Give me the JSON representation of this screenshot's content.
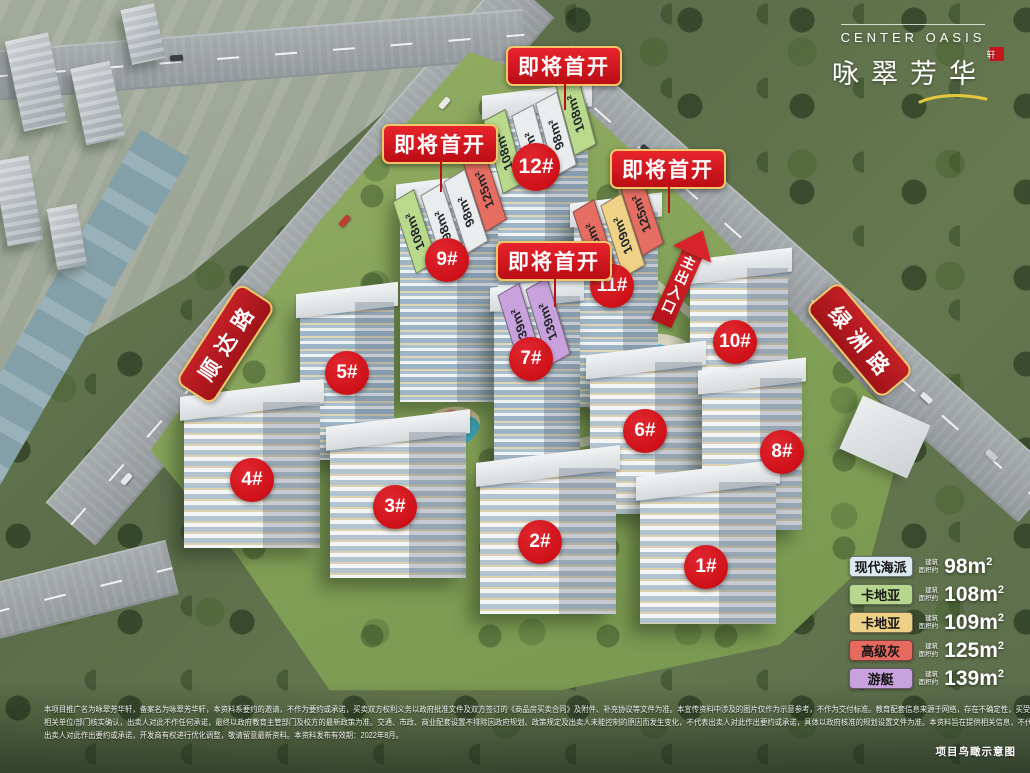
{
  "brand": {
    "en": "CENTER OASIS",
    "cn": "咏翠芳华",
    "sup": "轩"
  },
  "banner_label": "即将首开",
  "roads": {
    "left": "顺达路",
    "right": "绿洲路"
  },
  "entrance": {
    "label": "主出入口"
  },
  "buildings": [
    {
      "label": "1#"
    },
    {
      "label": "2#"
    },
    {
      "label": "3#"
    },
    {
      "label": "4#"
    },
    {
      "label": "5#"
    },
    {
      "label": "6#"
    },
    {
      "label": "7#"
    },
    {
      "label": "8#"
    },
    {
      "label": "9#"
    },
    {
      "label": "10#"
    },
    {
      "label": "11#"
    },
    {
      "label": "12#"
    }
  ],
  "tags": {
    "b12": [
      {
        "text": "108m²"
      },
      {
        "text": "98m²"
      },
      {
        "text": "98m²"
      },
      {
        "text": "108m²"
      }
    ],
    "b9": [
      {
        "text": "108m²"
      },
      {
        "text": "98m²"
      },
      {
        "text": "98m²"
      },
      {
        "text": "125m²"
      }
    ],
    "b11": [
      {
        "text": "125m²"
      },
      {
        "text": "109m²"
      },
      {
        "text": "125m²"
      }
    ],
    "b7": [
      {
        "text": "139m²"
      },
      {
        "text": "139m²"
      }
    ]
  },
  "legend": {
    "prefix_line1": "建筑",
    "prefix_line2": "面积约",
    "unit": "m",
    "sup": "2",
    "rows": [
      {
        "name": "现代海派",
        "area": "98",
        "color": "#dce9f0"
      },
      {
        "name": "卡地亚",
        "area": "108",
        "color": "#b7d78e"
      },
      {
        "name": "卡地亚",
        "area": "109",
        "color": "#edd187"
      },
      {
        "name": "高级灰",
        "area": "125",
        "color": "#e66a60"
      },
      {
        "name": "游艇",
        "area": "139",
        "color": "#c8a2dc"
      }
    ]
  },
  "disclaimer": {
    "lines": [
      "本项目推广名为咏翠芳华轩，备案名为咏翠芳华轩，本资料系要约的邀请，不作为要约或承诺，买卖双方权利义务以政府批准文件及双方签订的《商品房买卖合同》及附件、补充协议等文件为准。本宣传资料中涉及的图片仅作为示意参考，不作为交付标准。教育配套信息来源于网络，存在不确定性，买受人需自行与",
      "相关单位/部门核实确认，出卖人对此不作任何承诺，最终以政府教育主管部门及校方的最新政策为准。交通、市政、商业配套设置不排除因政府规划、政策规定及出卖人未能控制的原因而发生变化，不代表出卖人对此作出要约或承诺，具体以政府核准的规划设置文件为准。本资料旨在提供相关信息，不代表",
      "出卖人对此作出要约或承诺，开发商有权进行优化调整，敬请留意最新资料。本资料发布有效期：2022年8月。"
    ]
  },
  "caption": "项目鸟瞰示意图",
  "colors": {
    "banner_red1": "#e8242c",
    "banner_red2": "#bb0d15",
    "gold": "#f0c667",
    "badge_red": "#cf1118",
    "ribbon_red": "#a01318",
    "arrow_red": "#d8232a",
    "tag_green": "#b9d98c",
    "tag_white": "#e9edee",
    "tag_red": "#e56d61",
    "tag_yellow": "#efd285",
    "tag_purple": "#c9a2dd"
  }
}
